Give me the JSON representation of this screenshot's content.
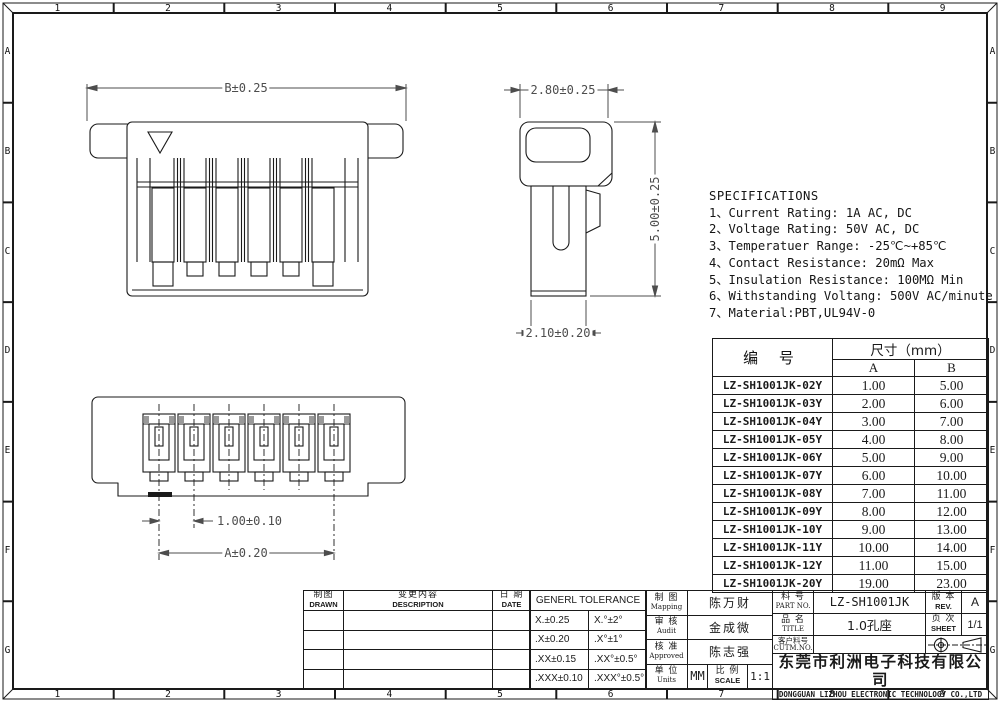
{
  "border": {
    "cols": [
      "1",
      "2",
      "3",
      "4",
      "5",
      "6",
      "7",
      "8",
      "9"
    ],
    "rows": [
      "A",
      "B",
      "C",
      "D",
      "E",
      "F",
      "G"
    ]
  },
  "views": {
    "front": {
      "dim_b": "B±0.25"
    },
    "side": {
      "dim_top": "2.80±0.25",
      "dim_right": "5.00±0.25",
      "dim_bottom": "2.10±0.20"
    },
    "bottom": {
      "dim_pitch": "1.00±0.10",
      "dim_a": "A±0.20"
    }
  },
  "specifications": {
    "title": "SPECIFICATIONS",
    "items": [
      "1、Current Rating: 1A AC, DC",
      "2、Voltage Rating: 50V AC, DC",
      "3、Temperatuer Range: -25℃~+85℃",
      "4、Contact Resistance: 20mΩ Max",
      "5、Insulation Resistance: 100MΩ Min",
      "6、Withstanding Voltang: 500V AC/minute",
      "7、Material:PBT,UL94V-0"
    ]
  },
  "parts_table": {
    "col_part": "编 号",
    "col_size": "尺寸（mm）",
    "col_a": "A",
    "col_b": "B",
    "rows": [
      {
        "part": "LZ-SH1001JK-02Y",
        "a": "1.00",
        "b": "5.00"
      },
      {
        "part": "LZ-SH1001JK-03Y",
        "a": "2.00",
        "b": "6.00"
      },
      {
        "part": "LZ-SH1001JK-04Y",
        "a": "3.00",
        "b": "7.00"
      },
      {
        "part": "LZ-SH1001JK-05Y",
        "a": "4.00",
        "b": "8.00"
      },
      {
        "part": "LZ-SH1001JK-06Y",
        "a": "5.00",
        "b": "9.00"
      },
      {
        "part": "LZ-SH1001JK-07Y",
        "a": "6.00",
        "b": "10.00"
      },
      {
        "part": "LZ-SH1001JK-08Y",
        "a": "7.00",
        "b": "11.00"
      },
      {
        "part": "LZ-SH1001JK-09Y",
        "a": "8.00",
        "b": "12.00"
      },
      {
        "part": "LZ-SH1001JK-10Y",
        "a": "9.00",
        "b": "13.00"
      },
      {
        "part": "LZ-SH1001JK-11Y",
        "a": "10.00",
        "b": "14.00"
      },
      {
        "part": "LZ-SH1001JK-12Y",
        "a": "11.00",
        "b": "15.00"
      },
      {
        "part": "LZ-SH1001JK-20Y",
        "a": "19.00",
        "b": "23.00"
      }
    ]
  },
  "title_block": {
    "drawn_cn": "制图",
    "drawn_en": "DRAWN",
    "desc_cn": "变更内容",
    "desc_en": "DESCRIPTION",
    "date_cn": "日 期",
    "date_en": "DATE",
    "tolerance_title": "GENERL TOLERANCE",
    "tolerance_rows": [
      [
        "X.±0.25",
        "X.°±2°"
      ],
      [
        ".X±0.20",
        ".X°±1°"
      ],
      [
        ".XX±0.15",
        ".XX°±0.5°"
      ],
      [
        ".XXX±0.10",
        ".XXX°±0.5°"
      ]
    ],
    "mapping_cn": "制 图",
    "mapping_en": "Mapping",
    "mapping_value": "陈万财",
    "audit_cn": "审 核",
    "audit_en": "Audit",
    "audit_value": "金成微",
    "approved_cn": "核 准",
    "approved_en": "Approved",
    "approved_value": "陈志强",
    "units_cn": "单 位",
    "units_en": "Units",
    "units_value": "MM",
    "scale_cn": "比 例",
    "scale_en": "SCALE",
    "scale_value": "1:1",
    "part_no_cn": "料 号",
    "part_no_en": "PART NO.",
    "part_no_value": "LZ-SH1001JK",
    "title_cn": "品 名",
    "title_en": "TITLE",
    "title_value": "1.0孔座",
    "cust_no_cn": "客户料号",
    "cust_no_en": "CUTM.NO.",
    "cust_no_value": "",
    "rev_cn": "版 本",
    "rev_en": "REV.",
    "rev_value": "A",
    "sheet_cn": "页 次",
    "sheet_en": "SHEET",
    "sheet_value": "1/1",
    "company_cn": "东莞市利洲电子科技有限公司",
    "company_en": "DONGGUAN LIZHOU ELECTRONIC TECHNOLOGY CO.,LTD"
  }
}
